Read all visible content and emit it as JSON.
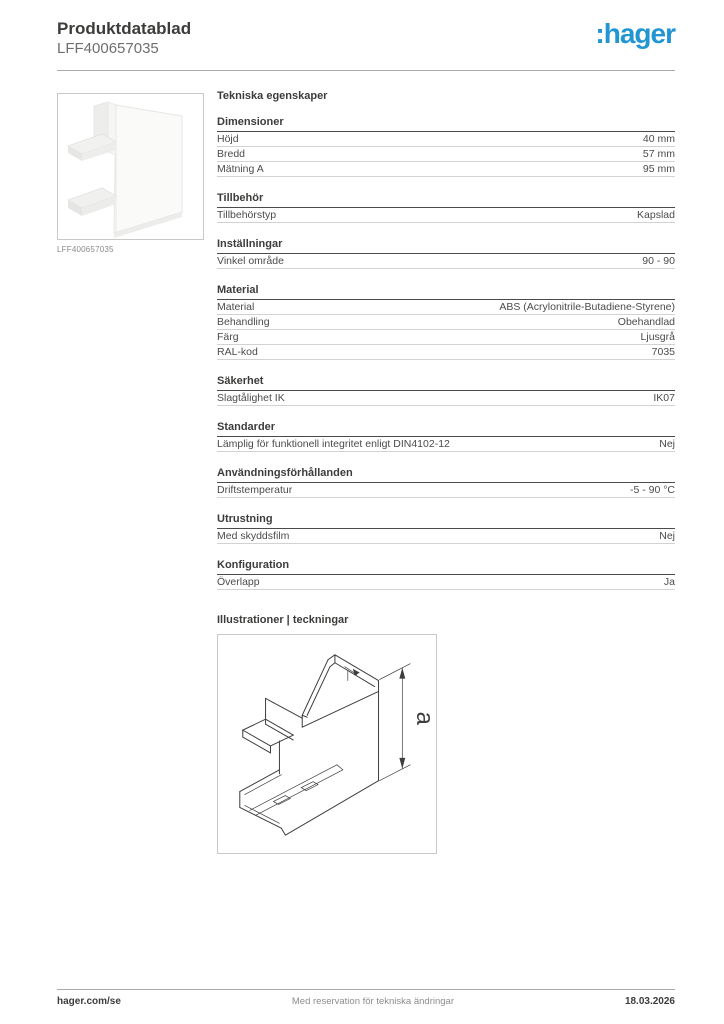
{
  "header": {
    "title": "Produktdatablad",
    "reference": "LFF400657035",
    "logo_text": ":hager",
    "logo_color": "#2196d3"
  },
  "product": {
    "image_caption": "LFF400657035"
  },
  "specs": {
    "heading": "Tekniska egenskaper",
    "sections": [
      {
        "title": "Dimensioner",
        "rows": [
          {
            "label": "Höjd",
            "value": "40 mm"
          },
          {
            "label": "Bredd",
            "value": "57 mm"
          },
          {
            "label": "Mätning A",
            "value": "95 mm"
          }
        ]
      },
      {
        "title": "Tillbehör",
        "rows": [
          {
            "label": "Tillbehörstyp",
            "value": "Kapslad"
          }
        ]
      },
      {
        "title": "Inställningar",
        "rows": [
          {
            "label": "Vinkel område",
            "value": "90 - 90"
          }
        ]
      },
      {
        "title": "Material",
        "rows": [
          {
            "label": "Material",
            "value": "ABS (Acrylonitrile-Butadiene-Styrene)"
          },
          {
            "label": "Behandling",
            "value": "Obehandlad"
          },
          {
            "label": "Färg",
            "value": "Ljusgrå"
          },
          {
            "label": "RAL-kod",
            "value": "7035"
          }
        ]
      },
      {
        "title": "Säkerhet",
        "rows": [
          {
            "label": "Slagtålighet IK",
            "value": "IK07"
          }
        ]
      },
      {
        "title": "Standarder",
        "rows": [
          {
            "label": "Lämplig för funktionell integritet enligt DIN4102-12",
            "value": "Nej"
          }
        ]
      },
      {
        "title": "Användningsförhållanden",
        "rows": [
          {
            "label": "Driftstemperatur",
            "value": "-5 - 90 °C"
          }
        ]
      },
      {
        "title": "Utrustning",
        "rows": [
          {
            "label": "Med skyddsfilm",
            "value": "Nej"
          }
        ]
      },
      {
        "title": "Konfiguration",
        "rows": [
          {
            "label": "Överlapp",
            "value": "Ja"
          }
        ]
      }
    ]
  },
  "illustrations": {
    "heading": "Illustrationer | teckningar",
    "dimension_label": "a"
  },
  "footer": {
    "website": "hager.com/se",
    "disclaimer": "Med reservation för tekniska ändringar",
    "date": "18.03.2026"
  }
}
